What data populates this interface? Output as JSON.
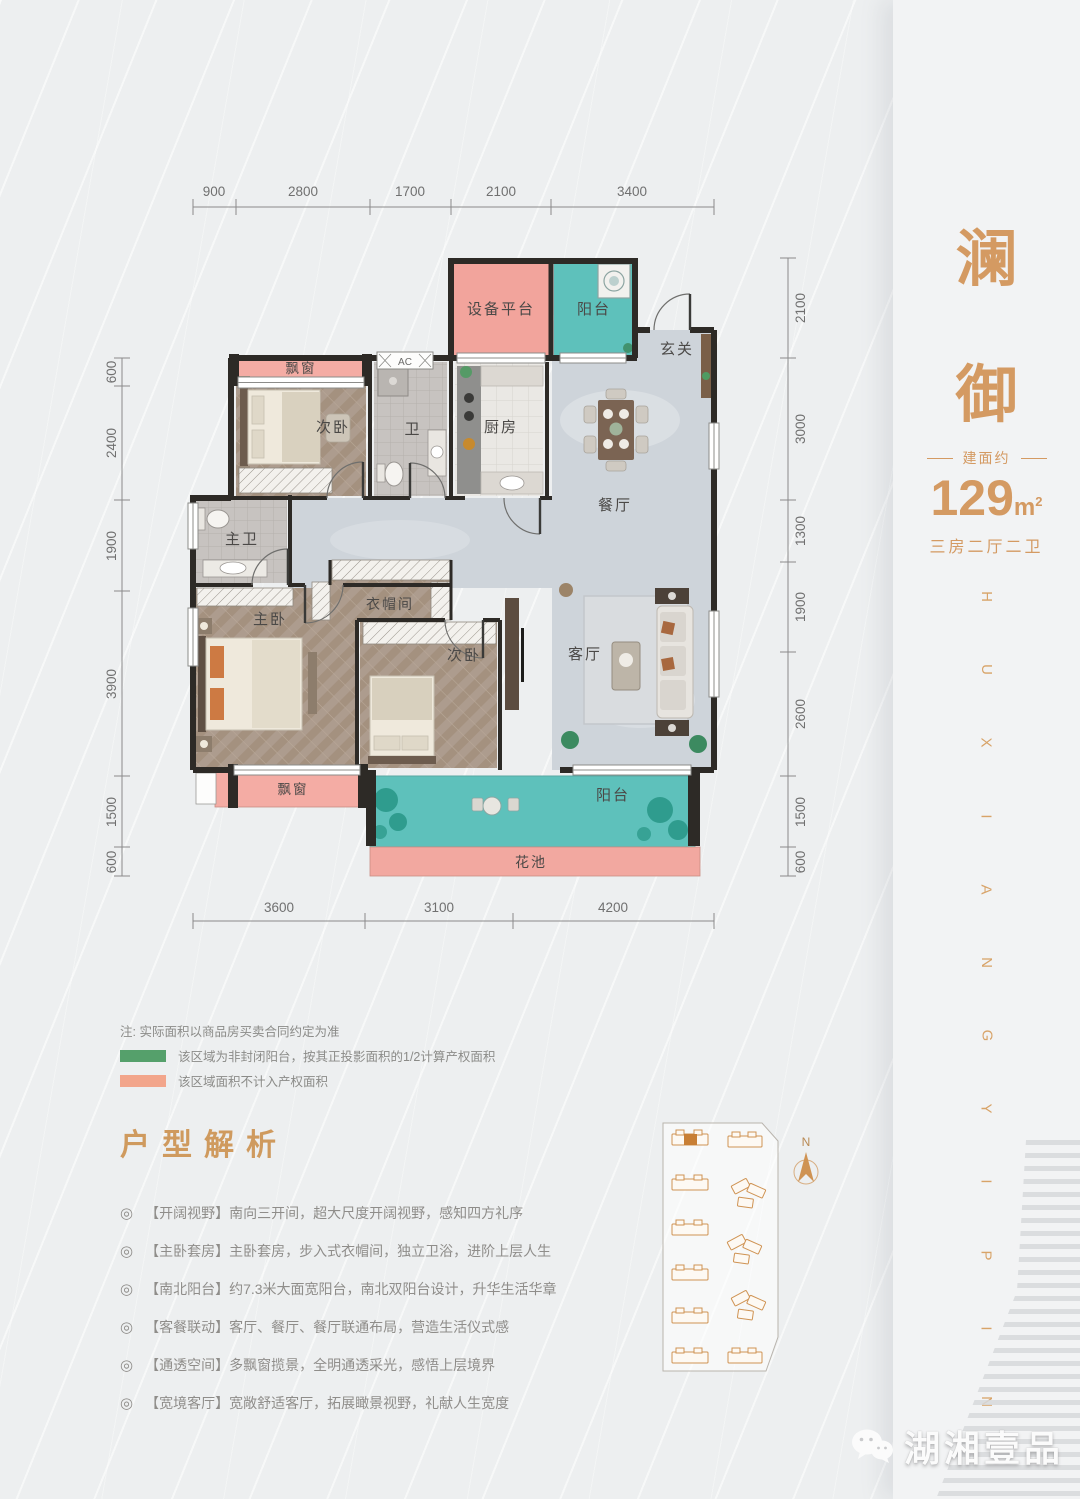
{
  "page": {
    "background": "#edeff0",
    "accent_gold": "#d49a62",
    "wall_color": "#2d2a26",
    "pink_zone": "#f2a8a0",
    "teal_zone": "#5ec1bb"
  },
  "plan": {
    "dims": {
      "top": [
        "900",
        "2800",
        "1700",
        "2100",
        "3400"
      ],
      "bottom": [
        "3600",
        "3100",
        "4200"
      ],
      "left": [
        "600",
        "2400",
        "1900",
        "3900",
        "1500",
        "600"
      ],
      "right": [
        "2100",
        "3000",
        "1300",
        "1900",
        "2600",
        "1500",
        "600"
      ]
    },
    "rooms": {
      "equipment_platform": "设备平台",
      "balcony_north": "阳台",
      "foyer": "玄关",
      "bay_window_north": "飘窗",
      "bedroom2": "次卧",
      "bath2": "卫",
      "ac": "AC",
      "kitchen": "厨房",
      "dining": "餐厅",
      "master_bath": "主卫",
      "closet": "衣帽间",
      "master_bedroom": "主卧",
      "bedroom3": "次卧",
      "living": "客厅",
      "bay_window_south": "飘窗",
      "balcony_south": "阳台",
      "flower_bed": "花池"
    }
  },
  "notes": {
    "disclaimer": "注: 实际面积以商品房买卖合同约定为准",
    "legend": [
      {
        "color": "#55a06b",
        "text": "该区域为非封闭阳台，按其正投影面积的1/2计算产权面积"
      },
      {
        "color": "#f2a58b",
        "text": "该区域面积不计入产权面积"
      }
    ]
  },
  "features": {
    "title": "户型解析",
    "bullet": "◎",
    "items": [
      "【开阔视野】南向三开间，超大尺度开阔视野，感知四方礼序",
      "【主卧套房】主卧套房，步入式衣帽间，独立卫浴，进阶上层人生",
      "【南北阳台】约7.3米大面宽阳台，南北双阳台设计，升华生活华章",
      "【客餐联动】客厅、餐厅、餐厅联通布局，营造生活仪式感",
      "【通透空间】多飘窗揽景，全明通透采光，感悟上层境界",
      "【宽境客厅】宽敞舒适客厅，拓展瞰景视野，礼献人生宽度"
    ]
  },
  "panel": {
    "name_chars": [
      "澜",
      "御"
    ],
    "area_label": "建面约",
    "area_value": "129",
    "area_unit_base": "m",
    "area_unit_sup": "2",
    "layout": "三房二厅二卫",
    "brand_letters": [
      "H",
      "U",
      "X",
      "I",
      "A",
      "N",
      "G",
      "Y",
      "I",
      "P",
      "I",
      "N"
    ]
  },
  "sitemap": {
    "north": "N",
    "building_color": "#cf9353",
    "highlight_color": "#c87f35"
  },
  "watermark": {
    "brand": "湖湘壹品"
  }
}
